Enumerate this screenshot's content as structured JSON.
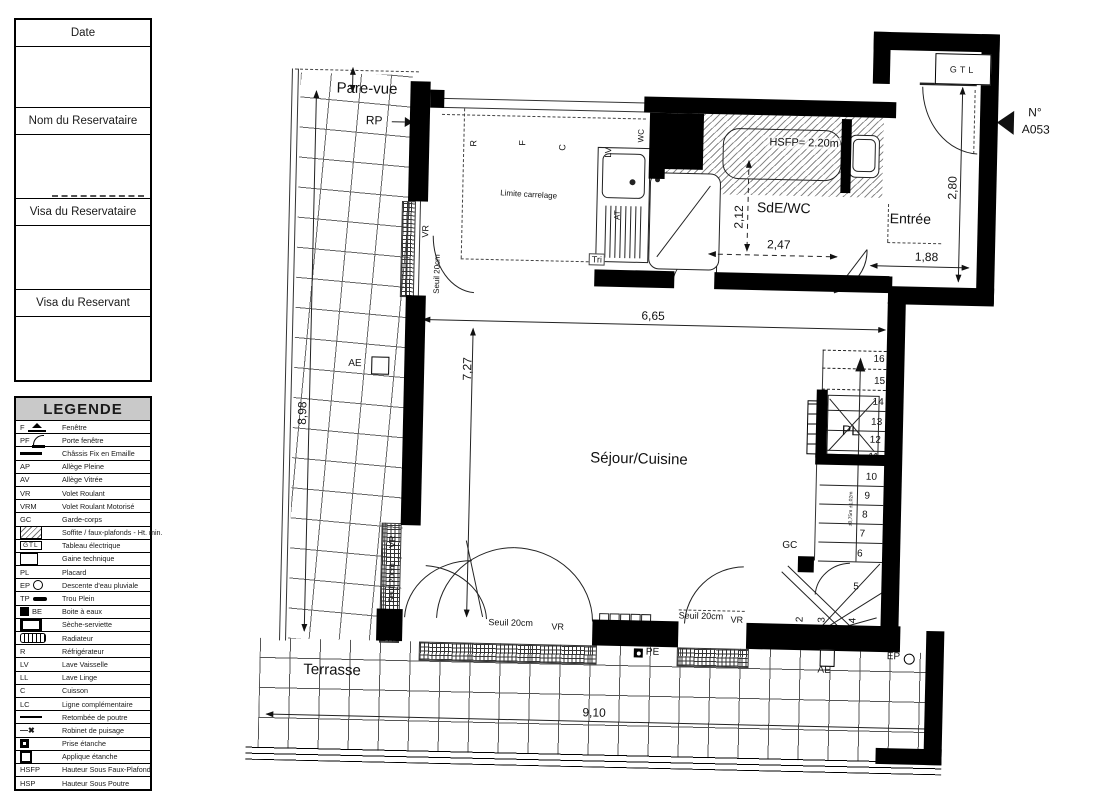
{
  "title_block": {
    "sections": [
      "Date",
      "Nom du Reservataire",
      "Visa du Reservataire",
      "Visa du Reservant"
    ]
  },
  "legend": {
    "title": "LEGENDE",
    "items": [
      {
        "abbr": "F",
        "symbol": "window",
        "label": "Fenêtre"
      },
      {
        "abbr": "PF",
        "symbol": "arc",
        "label": "Porte fenêtre"
      },
      {
        "abbr": "",
        "symbol": "thickline",
        "label": "Châssis Fix en Emaille"
      },
      {
        "abbr": "AP",
        "symbol": "",
        "label": "Allège Pleine"
      },
      {
        "abbr": "AV",
        "symbol": "",
        "label": "Allège Vitrée"
      },
      {
        "abbr": "VR",
        "symbol": "",
        "label": "Volet Roulant"
      },
      {
        "abbr": "VRM",
        "symbol": "",
        "label": "Volet Roulant Motorisé"
      },
      {
        "abbr": "GC",
        "symbol": "",
        "label": "Garde-corps"
      },
      {
        "abbr": "",
        "symbol": "hatch",
        "label": "Soffite / faux-plafonds - Ht. min."
      },
      {
        "abbr": "GTL",
        "symbol": "gtl",
        "label": "Tableau électrique"
      },
      {
        "abbr": "",
        "symbol": "gaine",
        "label": "Gaine technique"
      },
      {
        "abbr": "PL",
        "symbol": "",
        "label": "Placard"
      },
      {
        "abbr": "EP",
        "symbol": "circle",
        "label": "Descente d'eau pluviale"
      },
      {
        "abbr": "TP",
        "symbol": "bar",
        "label": "Trou Plein"
      },
      {
        "abbr": "BE",
        "symbol": "blacksq",
        "abbr_after": true,
        "label": "Boite à eaux"
      },
      {
        "abbr": "",
        "symbol": "seche",
        "label": "Sèche-serviette"
      },
      {
        "abbr": "",
        "symbol": "radiator",
        "label": "Radiateur"
      },
      {
        "abbr": "R",
        "symbol": "",
        "label": "Réfrigérateur"
      },
      {
        "abbr": "LV",
        "symbol": "",
        "label": "Lave Vaisselle"
      },
      {
        "abbr": "LL",
        "symbol": "",
        "label": "Lave Linge"
      },
      {
        "abbr": "C",
        "symbol": "",
        "label": "Cuisson"
      },
      {
        "abbr": "LC",
        "symbol": "",
        "label": "Ligne complémentaire"
      },
      {
        "abbr": "",
        "symbol": "line",
        "label": "Retombée de poutre"
      },
      {
        "abbr": "",
        "symbol": "robinet",
        "label": "Robinet de puisage"
      },
      {
        "abbr": "",
        "symbol": "prise",
        "label": "Prise étanche"
      },
      {
        "abbr": "",
        "symbol": "applique",
        "label": "Applique étanche"
      },
      {
        "abbr": "HSFP",
        "symbol": "",
        "label": "Hauteur Sous Faux-Plafond"
      },
      {
        "abbr": "HSP",
        "symbol": "",
        "label": "Hauteur Sous Poutre"
      }
    ]
  },
  "plan": {
    "unit": {
      "prefix": "N°",
      "code": "A053"
    },
    "rooms": {
      "sejour": "Séjour/Cuisine",
      "sde": "SdE/WC",
      "entree": "Entrée",
      "terrasse": "Terrasse",
      "placard": "PL"
    },
    "dims": {
      "w665": "6,65",
      "h727": "7,27",
      "h898": "8,98",
      "w910": "9,10",
      "h212": "2,12",
      "w247": "2,47",
      "h280": "2,80",
      "w188": "1,88"
    },
    "labels": {
      "pare_vue": "Pare-vue",
      "rp": "RP",
      "gtl": "GTL",
      "wc": "WC",
      "tri": "Tri",
      "at": "AT",
      "hsfp": "HSFP= 2.20m",
      "limite_carrelage": "Limite carrelage",
      "vr": "VR",
      "seuil": "Seuil 20cm",
      "gc": "GC",
      "ae": "AE",
      "pe": "PE",
      "ep": "EP",
      "stair_note": "±0,75m ±1,02m",
      "appliance_r": "R",
      "appliance_f": "F",
      "appliance_c": "C",
      "appliance_lv": "LV"
    },
    "stairs": {
      "numbers": [
        "16",
        "15",
        "14",
        "13",
        "12",
        "11",
        "10",
        "9",
        "8",
        "7",
        "6",
        "5",
        "4",
        "3",
        "2"
      ]
    }
  }
}
